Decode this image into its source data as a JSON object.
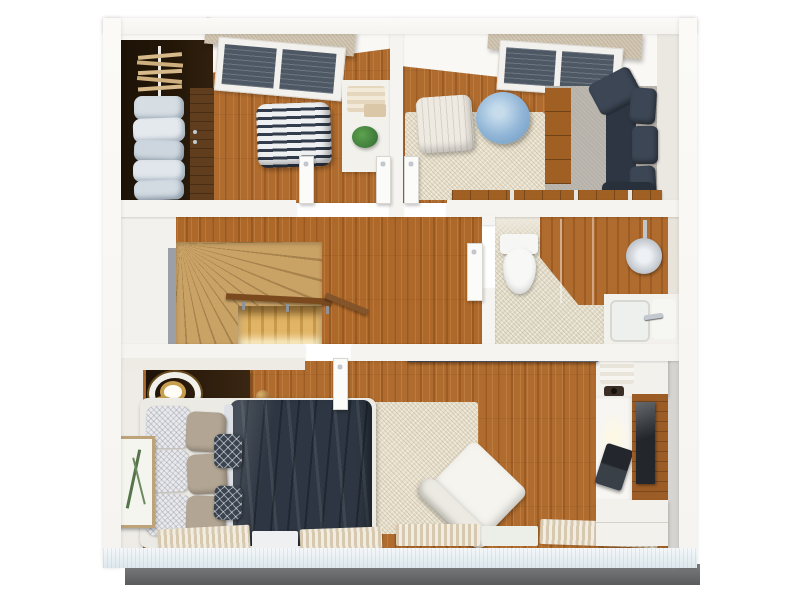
{
  "scene": {
    "kind": "3d-rendered-floor-plan-top-view",
    "floor": "upper-storey-apartment",
    "rooms": [
      {
        "id": "dressing-room",
        "position": "top-left",
        "objects": [
          "dark-wardrobe-with-hangers-and-clothes",
          "chevron-pouf",
          "white-vanity-cabinet",
          "potted-plant",
          "window-with-beige-pelmet",
          "double-interior-door",
          "wood-floor"
        ]
      },
      {
        "id": "lounge-room",
        "position": "top-right",
        "objects": [
          "window-with-beige-pelmet",
          "white-ribbed-ottoman",
          "light-blue-pouf",
          "beige-rug",
          "gray-carpet",
          "wood-dresser",
          "navy-corner-sofa",
          "low-wood-bench",
          "interior-door",
          "wood-floor"
        ]
      },
      {
        "id": "stair-hall",
        "position": "middle-left",
        "objects": [
          "winder-staircase",
          "wood-handrail",
          "stairwell-opening-to-lower-floor",
          "wood-floor"
        ]
      },
      {
        "id": "bathroom",
        "position": "middle-right",
        "objects": [
          "toilet",
          "wood-deck-walk-in-shower",
          "rain-shower-head",
          "white-vanity-sink-with-faucet",
          "tile-floor",
          "interior-door"
        ]
      },
      {
        "id": "master-bedroom",
        "position": "bottom",
        "objects": [
          "double-bed-navy-duvet",
          "white-patterned-pillows",
          "taupe-pillows",
          "accent-cushions",
          "dark-nightstand",
          "gold-ring-lamp",
          "framed-botanical-art",
          "beige-rug",
          "white-lounge-chair",
          "wall-shelf",
          "desk-and-tv-unit",
          "laptop",
          "striped-radiator-mats",
          "interior-door",
          "wood-floor"
        ]
      }
    ],
    "palette": {
      "wall_white": "#f6f4f0",
      "wall_edge": "#dfdcd6",
      "ceiling_white": "#faf8f4",
      "south_wall": "#dde8ee",
      "wood_main": "#b06c2e",
      "stair_wood": "#c9a266",
      "stair_line": "#a6824c",
      "stair_bright": "#e2b465",
      "stair_shadow": "#7a5524",
      "wardrobe_dark": "#241708",
      "wardrobe_door": "#5f3d1d",
      "navy": "#2d3642",
      "navy_light": "#3c4654",
      "beige_rug": "#e7dfcb",
      "gray_carpet": "#b6b1a9",
      "tile": "#e2dcc9",
      "chrome": "#c3c9cf",
      "gold": "#c79f4e",
      "taupe": "#b2a593",
      "blue_pouf": "#8fb4d6",
      "pelmet": "#c8bba6",
      "plant_green": "#3e7b3a",
      "plinth": "#6a6c6e",
      "white_furn": "#f3f1ec",
      "glass_dark": "#4d5864",
      "bench_wood": "#a05f23",
      "shelf_slate": "#515a63",
      "mat_dark": "#d6c9b0",
      "mat_light": "#f3ede1"
    }
  }
}
